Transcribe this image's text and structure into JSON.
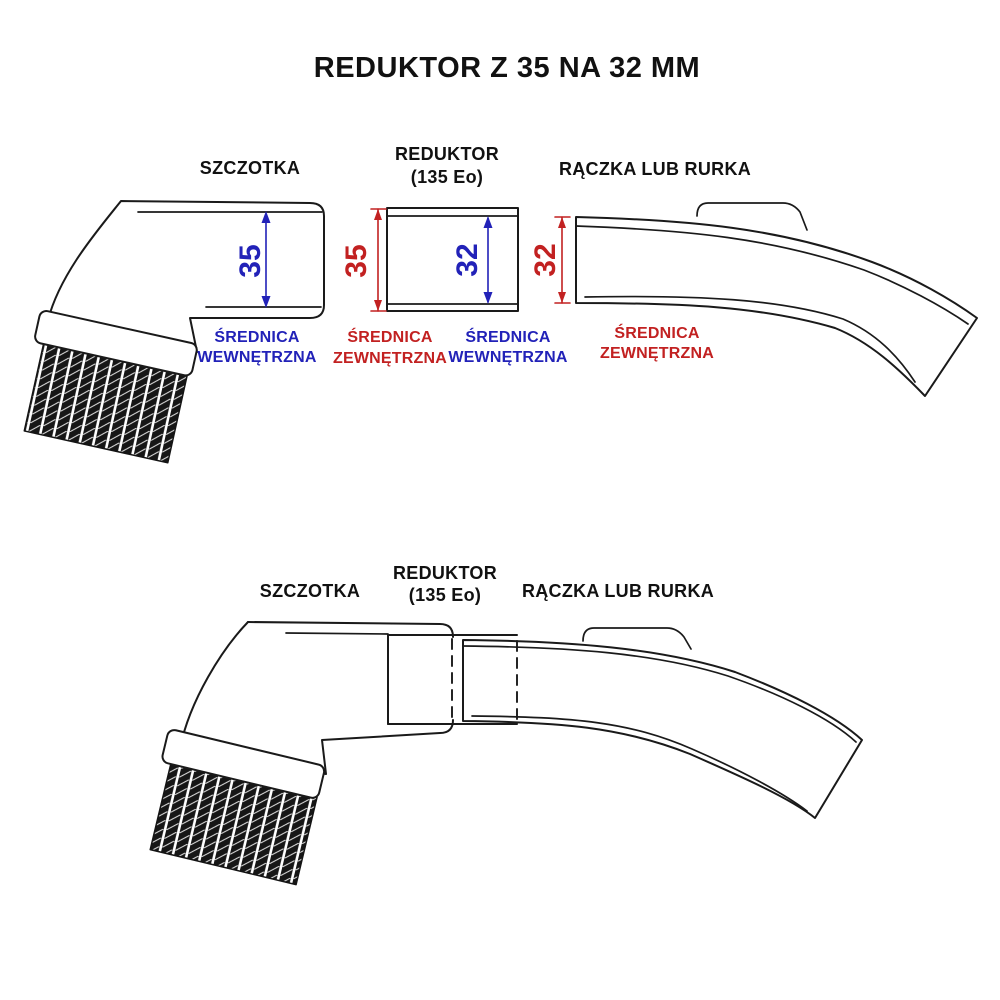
{
  "title": "REDUKTOR Z 35 NA 32 MM",
  "colors": {
    "line": "#1a1a1a",
    "inner_dim_blue": "#2222b8",
    "outer_dim_red": "#c22121",
    "background": "#ffffff"
  },
  "exploded_view": {
    "labels": {
      "szczotka": "SZCZOTKA",
      "reduktor_name": "REDUKTOR",
      "reduktor_model": "(135 Eo)",
      "raczka": "RĄCZKA LUB RURKA"
    },
    "dimensions": [
      {
        "value": "35",
        "caption_line1": "ŚREDNICA",
        "caption_line2": "WEWNĘTRZNA",
        "color": "blue",
        "applies_to": "szczotka"
      },
      {
        "value": "35",
        "caption_line1": "ŚREDNICA",
        "caption_line2": "ZEWNĘTRZNA",
        "color": "red",
        "applies_to": "reduktor"
      },
      {
        "value": "32",
        "caption_line1": "ŚREDNICA",
        "caption_line2": "WEWNĘTRZNA",
        "color": "blue",
        "applies_to": "reduktor"
      },
      {
        "value": "32",
        "caption_line1": "ŚREDNICA",
        "caption_line2": "ZEWNĘTRZNA",
        "color": "red",
        "applies_to": "raczka"
      }
    ]
  },
  "assembled_view": {
    "labels": {
      "szczotka": "SZCZOTKA",
      "reduktor_name": "REDUKTOR",
      "reduktor_model": "(135 Eo)",
      "raczka": "RĄCZKA LUB RURKA"
    }
  }
}
